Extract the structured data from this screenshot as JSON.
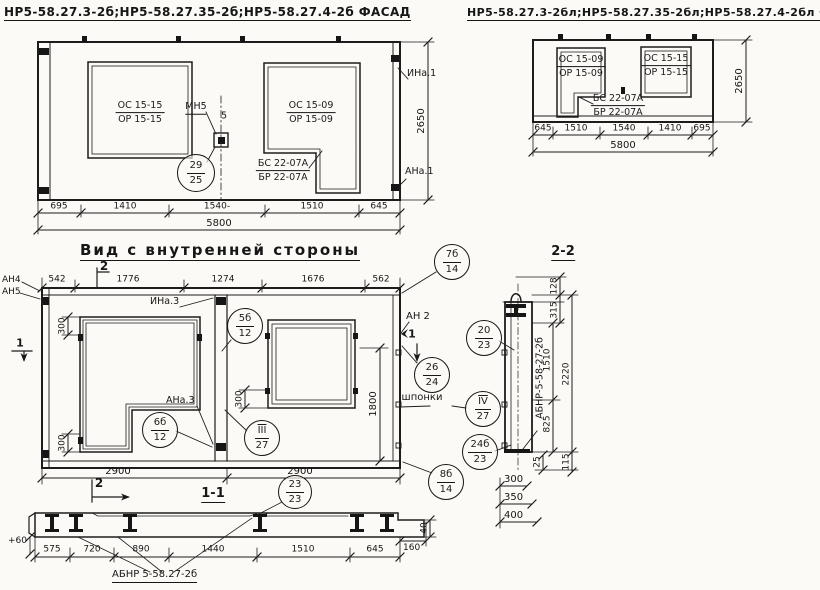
{
  "colors": {
    "paper": "#fbfaf6",
    "ink": "#1c1c1c"
  },
  "titles": {
    "facade_left": "НР5-58.27.3-2б;НР5-58.27.35-2б;НР5-58.27.4-2б ФАСАД",
    "facade_right": "НР5-58.27.3-2бл;НР5-58.27.35-2бл;НР5-58.27.4-2бл ФАСАД",
    "inner_view": "Вид с внутренней стороны",
    "section_2": "2-2",
    "section_1": "1-1"
  },
  "facade_left": {
    "win1_top": "ОС 15-15",
    "win1_bot": "ОР 15-15",
    "win2_top": "ОС 15-09",
    "win2_bot": "ОР 15-09",
    "lintel_top": "БС 22-07А",
    "lintel_bot": "БР 22-07А",
    "mark_mn5": "МН5",
    "mark_5": "5",
    "callout_top": "29",
    "callout_bot": "25",
    "mark_ina1": "ИНа.1",
    "mark_ana1": "АНа.1",
    "dims": [
      "695",
      "1410",
      "1540-",
      "1510",
      "645"
    ],
    "total": "5800",
    "height": "2650"
  },
  "facade_right": {
    "win1_top": "ОС 15-09",
    "win1_bot": "ОР 15-09",
    "win2_top": "ОС 15-15",
    "win2_bot": "ОР 15-15",
    "lintel_top": "БС 22-07А",
    "lintel_bot": "БР 22-07А",
    "dims": [
      "645",
      "1510",
      "1540",
      "1410",
      "695"
    ],
    "total": "5800",
    "height": "2650"
  },
  "inner_view": {
    "dims_top": [
      "542",
      "1776",
      "1274",
      "1676",
      "562"
    ],
    "dims_bottom": [
      "2900",
      "2900"
    ],
    "dim_1800": "1800",
    "dim_300_top": "300",
    "dim_300_bottom": "300",
    "dim_300_win": "300",
    "mark_an4": "АН4",
    "mark_an5": "АН5",
    "mark_an2": "АН 2",
    "mark_ina3": "ИНа.3",
    "mark_ana3": "АНа.3",
    "label_keys": "шпонки",
    "cut_1": "1",
    "cut_2": "2",
    "callouts": {
      "c7b14": [
        "7б",
        "14"
      ],
      "c5b12": [
        "5б",
        "12"
      ],
      "c3_27": [
        "III",
        "27"
      ],
      "c6b12": [
        "6б",
        "12"
      ],
      "c26_24": [
        "26",
        "24"
      ],
      "c20_23": [
        "20",
        "23"
      ],
      "c4_27": [
        "IV",
        "27"
      ],
      "c24b23": [
        "24б",
        "23"
      ],
      "c8b14": [
        "8б",
        "14"
      ]
    }
  },
  "section_2": {
    "label": "АБНР-5-58-27-2б",
    "d128": "128",
    "d315": "315",
    "d1510": "1510",
    "d2220": "2220",
    "d825": "825",
    "d25": "25",
    "d115": "115",
    "d300": "300",
    "d350": "350",
    "d400": "400"
  },
  "plan_1": {
    "callout": [
      "23",
      "23"
    ],
    "dims": [
      "575",
      "720",
      "890",
      "1440",
      "1510",
      "645"
    ],
    "d60": "+60",
    "d40": "40",
    "d160": "160",
    "label": "АБНР 5-58.27-2б",
    "cut_2": "2"
  }
}
